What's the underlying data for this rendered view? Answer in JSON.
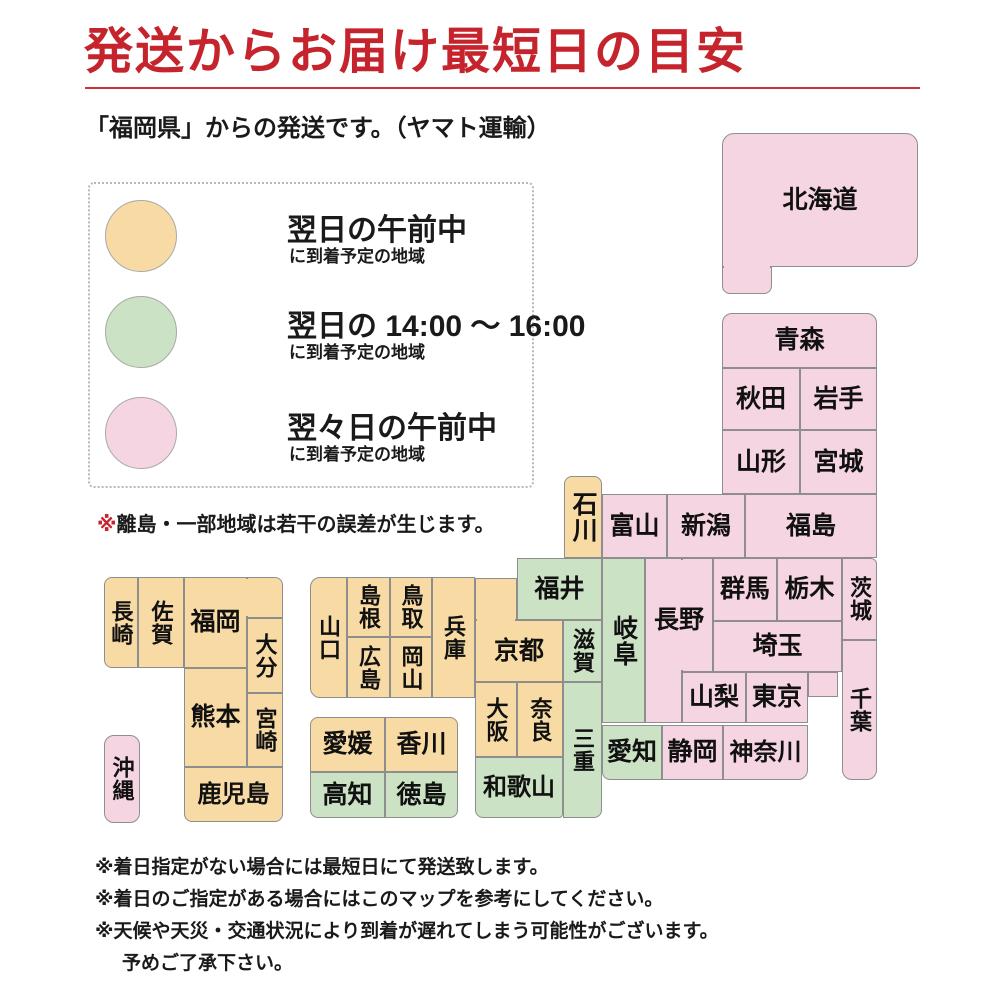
{
  "title": "発送からお届け最短日の目安",
  "subtitle": "「福岡県」からの発送です。（ヤマト運輸）",
  "colors": {
    "next_morning": "#f8dba4",
    "next_afternoon": "#cbe2c4",
    "two_days": "#f6d5e2",
    "accent_red": "#c5242c"
  },
  "legend": {
    "items": [
      {
        "zone": "next_morning",
        "label": "翌日の午前中",
        "sublabel": "に到着予定の地域"
      },
      {
        "zone": "next_afternoon",
        "label": "翌日の 14:00 ～ 16:00",
        "sublabel": "に到着予定の地域"
      },
      {
        "zone": "two_days",
        "label": "翌々日の午前中",
        "sublabel": "に到着予定の地域"
      }
    ]
  },
  "map_note": {
    "mark": "※",
    "text": "離島・一部地域は若干の誤差が生じます。"
  },
  "map": {
    "prefectures": [
      {
        "name": "北海道",
        "zone": "two_days"
      },
      {
        "name": "青森",
        "zone": "two_days"
      },
      {
        "name": "秋田",
        "zone": "two_days"
      },
      {
        "name": "岩手",
        "zone": "two_days"
      },
      {
        "name": "山形",
        "zone": "two_days"
      },
      {
        "name": "宮城",
        "zone": "two_days"
      },
      {
        "name": "新潟",
        "zone": "two_days"
      },
      {
        "name": "富山",
        "zone": "two_days"
      },
      {
        "name": "福島",
        "zone": "two_days"
      },
      {
        "name": "石川",
        "zone": "next_morning"
      },
      {
        "name": "群馬",
        "zone": "two_days"
      },
      {
        "name": "栃木",
        "zone": "two_days"
      },
      {
        "name": "茨城",
        "zone": "two_days"
      },
      {
        "name": "長野",
        "zone": "two_days"
      },
      {
        "name": "埼玉",
        "zone": "two_days"
      },
      {
        "name": "山梨",
        "zone": "two_days"
      },
      {
        "name": "東京",
        "zone": "two_days"
      },
      {
        "name": "千葉",
        "zone": "two_days"
      },
      {
        "name": "岐阜",
        "zone": "next_afternoon"
      },
      {
        "name": "愛知",
        "zone": "next_afternoon"
      },
      {
        "name": "静岡",
        "zone": "two_days"
      },
      {
        "name": "神奈川",
        "zone": "two_days"
      },
      {
        "name": "福井",
        "zone": "next_afternoon"
      },
      {
        "name": "滋賀",
        "zone": "next_afternoon"
      },
      {
        "name": "三重",
        "zone": "next_afternoon"
      },
      {
        "name": "京都",
        "zone": "next_morning"
      },
      {
        "name": "大阪",
        "zone": "next_morning"
      },
      {
        "name": "奈良",
        "zone": "next_morning"
      },
      {
        "name": "和歌山",
        "zone": "next_afternoon"
      },
      {
        "name": "兵庫",
        "zone": "next_morning"
      },
      {
        "name": "鳥取",
        "zone": "next_morning"
      },
      {
        "name": "岡山",
        "zone": "next_morning"
      },
      {
        "name": "島根",
        "zone": "next_morning"
      },
      {
        "name": "広島",
        "zone": "next_morning"
      },
      {
        "name": "山口",
        "zone": "next_morning"
      },
      {
        "name": "愛媛",
        "zone": "next_morning"
      },
      {
        "name": "香川",
        "zone": "next_morning"
      },
      {
        "name": "高知",
        "zone": "next_afternoon"
      },
      {
        "name": "徳島",
        "zone": "next_afternoon"
      },
      {
        "name": "長崎",
        "zone": "next_morning"
      },
      {
        "name": "佐賀",
        "zone": "next_morning"
      },
      {
        "name": "福岡",
        "zone": "next_morning"
      },
      {
        "name": "大分",
        "zone": "next_morning"
      },
      {
        "name": "熊本",
        "zone": "next_morning"
      },
      {
        "name": "宮崎",
        "zone": "next_morning"
      },
      {
        "name": "鹿児島",
        "zone": "next_morning"
      },
      {
        "name": "沖縄",
        "zone": "two_days"
      }
    ]
  },
  "footnotes": [
    "※着日指定がない場合には最短日にて発送致します。",
    "※着日のご指定がある場合にはこのマップを参考にしてください。",
    "※天候や天災・交通状況により到着が遅れてしまう可能性がございます。",
    "予めご了承下さい。"
  ]
}
